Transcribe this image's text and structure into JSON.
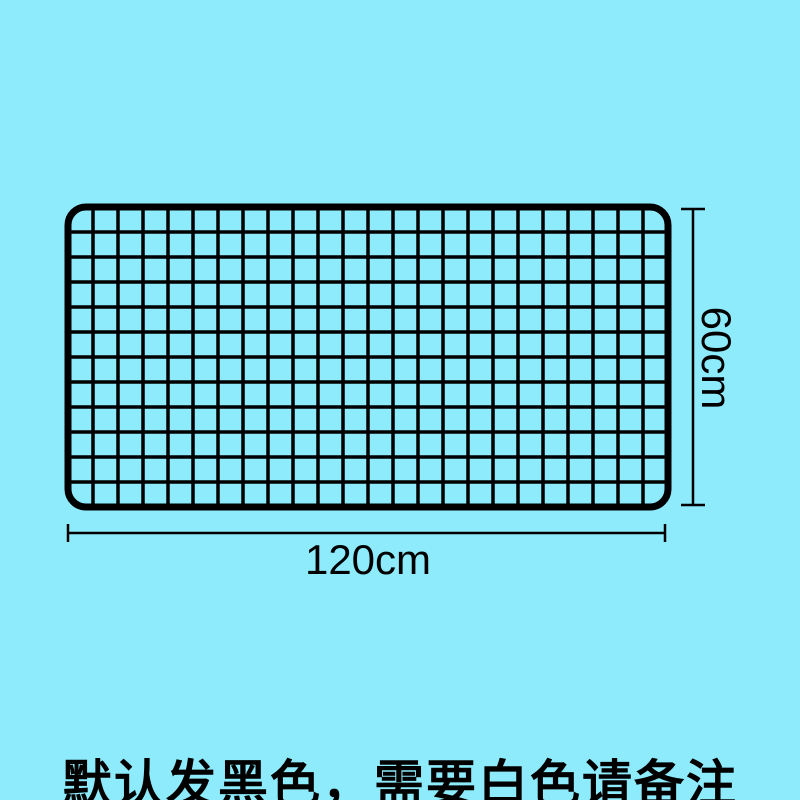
{
  "colors": {
    "background": "#8DEBFC",
    "line": "#000000"
  },
  "diagram": {
    "grid": {
      "columns": 24,
      "rows": 12
    },
    "width_label": "120cm",
    "height_label": "60cm"
  },
  "note": {
    "text": "默认发黑色，需要白色请备注"
  }
}
